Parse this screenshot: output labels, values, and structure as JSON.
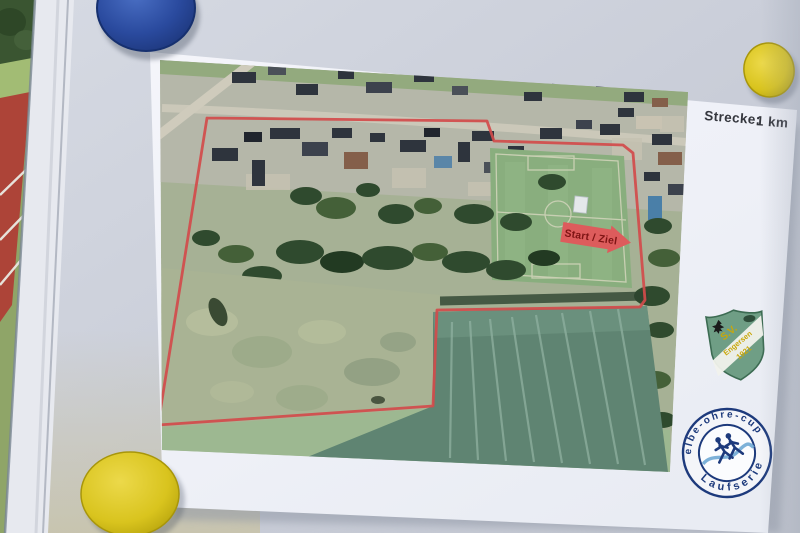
{
  "header": {
    "strecke_label": "Strecke:",
    "strecke_value": "1 km"
  },
  "map": {
    "start_finish_label": "Start / Ziel",
    "route_points": [
      [
        207,
        118
      ],
      [
        487,
        121
      ],
      [
        494,
        141
      ],
      [
        623,
        145
      ],
      [
        633,
        153
      ],
      [
        645,
        300
      ],
      [
        640,
        307
      ],
      [
        437,
        310
      ],
      [
        433,
        406
      ],
      [
        158,
        425
      ],
      [
        207,
        118
      ]
    ]
  },
  "club_crest": {
    "line1": "S.V.",
    "line2": "Engersen",
    "line3": "1921"
  },
  "series_badge": {
    "top_text": "elbe-ohre-cup",
    "bottom_text": "Laufserie"
  },
  "magnets": [
    {
      "name": "magnet-blue-top",
      "color": "#2a4a9e"
    },
    {
      "name": "magnet-yellow-top-right",
      "color": "#d9c41e"
    },
    {
      "name": "magnet-yellow-bottom-left",
      "color": "#ddc715"
    }
  ],
  "colors": {
    "route": "#d34b4b",
    "arrow": "#dd5c5c",
    "arrow_text": "#7e1414",
    "crest_green": "#6f9e85",
    "crest_text": "#c9a70a",
    "badge_navy": "#1d3a7c",
    "badge_wave": "#6fa8d4",
    "track_red": "#ad4438",
    "board_gray": "#c9cdd8",
    "paper_white": "#f2f3f9"
  }
}
